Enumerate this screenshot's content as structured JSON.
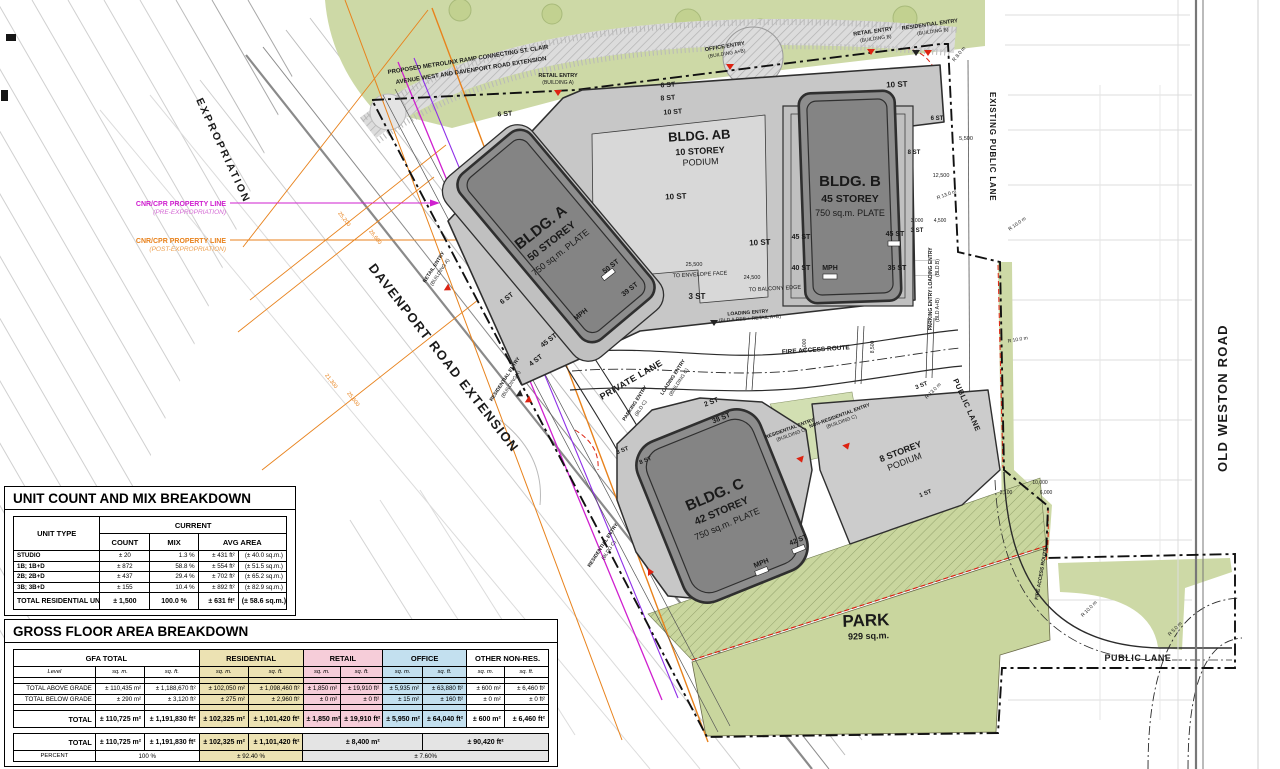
{
  "plan": {
    "street_labels": {
      "expropriation": "EXPROPRIATION",
      "davenport": "DAVENPORT ROAD EXTENSION",
      "old_weston": "OLD WESTON ROAD",
      "existing_public_lane": "EXISTING PUBLIC LANE",
      "public_lane_diag": "PUBLIC LANE",
      "public_lane_bottom": "PUBLIC LANE",
      "private_lane": "PRIVATE LANE",
      "fire_access_route": "FIRE ACCESS ROUTE",
      "fire_access_route_2": "FIRE ACCESS ROUTE"
    },
    "property_lines": {
      "pre_line1": "CNR/CPR PROPERTY LINE",
      "pre_line2": "(PRE-EXPROPRIATION)",
      "post_line1": "CNR/CPR PROPERTY LINE",
      "post_line2": "(POST-EXPROPRIATION)"
    },
    "notes": {
      "metrolinx_1": "PROPOSED METROLINX RAMP CONNECTING ST. CLAIR",
      "metrolinx_2": "AVENUE WEST AND DAVENPORT ROAD EXTENSION",
      "to_envelope_face": "TO ENVELOPE FACE",
      "to_balcony_edge": "TO BALCONY EDGE"
    },
    "park": {
      "title": "PARK",
      "area": "929 sq.m."
    },
    "buildings": {
      "a": {
        "name": "BLDG. A",
        "storeys": "50 STOREY",
        "plate": "750 sq.m. PLATE"
      },
      "b": {
        "name": "BLDG. B",
        "storeys": "45 STOREY",
        "plate": "750 sq.m. PLATE"
      },
      "c": {
        "name": "BLDG. C",
        "storeys": "42 STOREY",
        "plate": "750 sq.m. PLATE"
      },
      "ab": {
        "name": "BLDG. AB",
        "storeys": "10 STOREY",
        "label": "PODIUM"
      },
      "podium8": {
        "storeys": "8 STOREY",
        "label": "PODIUM"
      }
    },
    "entries": [
      {
        "l1": "RETAIL ENTRY",
        "l2": "(BUILDING A)"
      },
      {
        "l1": "OFFICE ENTRY",
        "l2": "(BUILDING A+B)"
      },
      {
        "l1": "RETAIL ENTRY",
        "l2": "(BUILDING B)"
      },
      {
        "l1": "RESIDENTIAL ENTRY",
        "l2": "(BUILDING B)"
      },
      {
        "l1": "RETAIL ENTRY",
        "l2": "(BUILDING A)"
      },
      {
        "l1": "RESIDENTIAL ENTRY",
        "l2": "(BUILDING A)"
      },
      {
        "l1": "RESIDENTIAL ENTRY",
        "l2": "(BLDG C)"
      },
      {
        "l1": "RESIDENTIAL ENTRY",
        "l2": "(BUILDING C)"
      },
      {
        "l1": "NON-RESIDENTIAL ENTRY",
        "l2": "(BUILDING C)"
      },
      {
        "l1": "LOADING ENTRY",
        "l2": "(BLD A RES + RETAIL A+B)"
      },
      {
        "l1": "LOADING ENTRY",
        "l2": "(BLD.B)"
      },
      {
        "l1": "PARKING ENTRY",
        "l2": "(BLD A+B)"
      },
      {
        "l1": "LOADING ENTRY",
        "l2": "(BUILDING C)"
      },
      {
        "l1": "PARKING ENTRY",
        "l2": "(BLD C)"
      }
    ],
    "storey_labels": [
      "6 ST",
      "6 ST",
      "8 ST",
      "10 ST",
      "10 ST",
      "10 ST",
      "10 ST",
      "6 ST",
      "8 ST",
      "45 ST",
      "45 ST",
      "40 ST",
      "MPH",
      "35 ST",
      "3 ST",
      "50 ST",
      "39 ST",
      "MPH",
      "45 ST",
      "6 ST",
      "4 ST",
      "3 ST",
      "38 ST",
      "42 ST",
      "MPH",
      "3 ST",
      "8 ST",
      "2 ST",
      "3 ST",
      "1 ST"
    ],
    "dimensions": [
      "5,500",
      "12,500",
      "3,000",
      "4,500",
      "10,000",
      "6,000",
      "2,100",
      "25,500",
      "24,500",
      "25,200",
      "26,600",
      "25,600",
      "21,300",
      "6,000",
      "8,500"
    ],
    "radius_labels": [
      "R 8.0 m",
      "R 13.0 m",
      "R 10.0 m",
      "R 10.0 m",
      "R 10.0 m",
      "R 5.0 m",
      "R 13.0 m"
    ]
  },
  "unit_table": {
    "title": "UNIT COUNT AND MIX BREAKDOWN",
    "headers": {
      "unit_type": "UNIT TYPE",
      "current": "CURRENT",
      "count": "COUNT",
      "mix": "MIX",
      "avg_area": "AVG AREA"
    },
    "rows": [
      {
        "type": "STUDIO",
        "count": "± 20",
        "mix": "1.3 %",
        "avg_ft": "± 431 ft²",
        "avg_m": "(± 40.0 sq.m.)"
      },
      {
        "type": "1B; 1B+D",
        "count": "± 872",
        "mix": "58.8 %",
        "avg_ft": "± 554 ft²",
        "avg_m": "(± 51.5 sq.m.)"
      },
      {
        "type": "2B; 2B+D",
        "count": "± 437",
        "mix": "29.4 %",
        "avg_ft": "± 702 ft²",
        "avg_m": "(± 65.2 sq.m.)"
      },
      {
        "type": "3B; 3B+D",
        "count": "± 155",
        "mix": "10.4 %",
        "avg_ft": "± 892 ft²",
        "avg_m": "(± 82.9 sq.m.)"
      }
    ],
    "total": {
      "type": "TOTAL RESIDENTIAL UNITS",
      "count": "± 1,500",
      "mix": "100.0 %",
      "avg_ft": "± 631 ft²",
      "avg_m": "(± 58.6 sq.m.)"
    }
  },
  "gfa_table": {
    "title": "GROSS FLOOR AREA BREAKDOWN",
    "groups": [
      "GFA TOTAL",
      "RESIDENTIAL",
      "RETAIL",
      "OFFICE",
      "OTHER NON-RES."
    ],
    "level_label": "Level",
    "sqm": "sq. m.",
    "sqft": "sq. ft.",
    "rows": {
      "above": {
        "label": "TOTAL ABOVE GRADE",
        "cells": [
          "± 110,435 m²",
          "± 1,188,670 ft²",
          "± 102,050 m²",
          "± 1,098,460 ft²",
          "± 1,850 m²",
          "± 19,910 ft²",
          "± 5,935 m²",
          "± 63,880 ft²",
          "± 600 m²",
          "± 6,460 ft²"
        ]
      },
      "below": {
        "label": "TOTAL BELOW GRADE",
        "cells": [
          "± 290 m²",
          "± 3,120 ft²",
          "± 275 m²",
          "± 2,960 ft²",
          "± 0 m²",
          "± 0 ft²",
          "± 15 m²",
          "± 160 ft²",
          "± 0 m²",
          "± 0 ft²"
        ]
      },
      "total": {
        "label": "TOTAL",
        "cells": [
          "± 110,725 m²",
          "± 1,191,830 ft²",
          "± 102,325 m²",
          "± 1,101,420 ft²",
          "± 1,850 m²",
          "± 19,910 ft²",
          "± 5,950 m²",
          "± 64,040 ft²",
          "± 600 m²",
          "± 6,460 ft²"
        ]
      }
    },
    "summary": {
      "total_label": "TOTAL",
      "cells": [
        "± 110,725 m²",
        "± 1,191,830 ft²",
        "± 102,325 m²",
        "± 1,101,420 ft²",
        "± 8,400 m²",
        "± 90,420 ft²"
      ],
      "percent_label": "PERCENT",
      "percent_cells": [
        "100 %",
        "± 92.40 %",
        "± 7.60%"
      ]
    }
  },
  "colors": {
    "orange": "#e8821c",
    "magenta": "#cf1fcf",
    "purple": "#8f2fe8",
    "red": "#dd2211",
    "park_green": "#c9d69e",
    "residential_tint": "#ece2b3",
    "retail_tint": "#f6cdd9",
    "office_tint": "#c3e0ef"
  }
}
